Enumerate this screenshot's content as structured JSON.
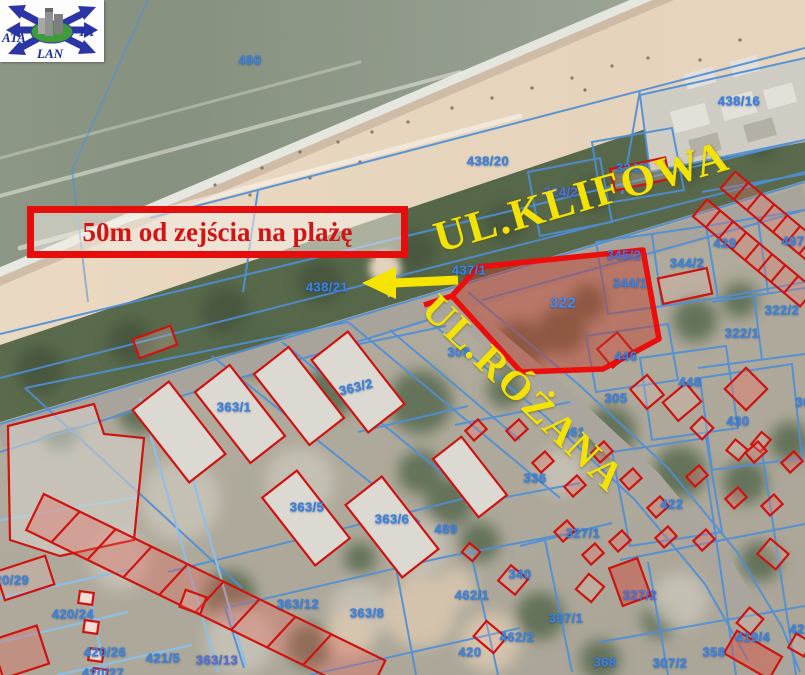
{
  "logo": {
    "left_text": "ATA",
    "right_text": "TA",
    "bottom_text": "LAN"
  },
  "annotation": {
    "text": "50m od zejścia na plażę"
  },
  "streets": {
    "klifowa": "UL.KLIFOWA",
    "rozana": "UL.RÓŻANA"
  },
  "highlighted_parcel": {
    "number": "322"
  },
  "colors": {
    "highlight_red": "#ec0d0d",
    "street_yellow": "#f2e205",
    "parcel_blue": "#3d85dc",
    "annotation_red": "#d41414"
  },
  "parcels": [
    {
      "label": "490",
      "x": 250,
      "y": 60
    },
    {
      "label": "438/16",
      "x": 739,
      "y": 101
    },
    {
      "label": "438/20",
      "x": 488,
      "y": 161
    },
    {
      "label": "324/1",
      "x": 633,
      "y": 168
    },
    {
      "label": "324/2",
      "x": 561,
      "y": 192,
      "cls": "p"
    },
    {
      "label": "344/1",
      "x": 630,
      "y": 283
    },
    {
      "label": "344/2",
      "x": 687,
      "y": 263
    },
    {
      "label": "345/2",
      "x": 624,
      "y": 255,
      "cls": "p"
    },
    {
      "label": "429",
      "x": 725,
      "y": 243
    },
    {
      "label": "497",
      "x": 793,
      "y": 241
    },
    {
      "label": "322/2",
      "x": 782,
      "y": 310
    },
    {
      "label": "322/1",
      "x": 742,
      "y": 333
    },
    {
      "label": "438/21",
      "x": 327,
      "y": 287
    },
    {
      "label": "437/1",
      "x": 469,
      "y": 270
    },
    {
      "label": "308",
      "x": 459,
      "y": 352
    },
    {
      "label": "446",
      "x": 626,
      "y": 356
    },
    {
      "label": "448",
      "x": 690,
      "y": 382
    },
    {
      "label": "430",
      "x": 738,
      "y": 421
    },
    {
      "label": "305",
      "x": 616,
      "y": 398
    },
    {
      "label": "305",
      "x": 807,
      "y": 402
    },
    {
      "label": "361",
      "x": 574,
      "y": 432
    },
    {
      "label": "336",
      "x": 535,
      "y": 478
    },
    {
      "label": "422",
      "x": 672,
      "y": 504
    },
    {
      "label": "327/1",
      "x": 583,
      "y": 533
    },
    {
      "label": "363/1",
      "x": 234,
      "y": 407
    },
    {
      "label": "363/2",
      "x": 356,
      "y": 387,
      "rot": -14
    },
    {
      "label": "363/5",
      "x": 307,
      "y": 507
    },
    {
      "label": "363/6",
      "x": 392,
      "y": 519
    },
    {
      "label": "489",
      "x": 446,
      "y": 529
    },
    {
      "label": "340",
      "x": 520,
      "y": 574
    },
    {
      "label": "462/1",
      "x": 472,
      "y": 595
    },
    {
      "label": "462/2",
      "x": 517,
      "y": 637
    },
    {
      "label": "420",
      "x": 470,
      "y": 652
    },
    {
      "label": "307/1",
      "x": 566,
      "y": 618
    },
    {
      "label": "327/2",
      "x": 640,
      "y": 595,
      "cls": "p"
    },
    {
      "label": "368",
      "x": 605,
      "y": 662
    },
    {
      "label": "307/2",
      "x": 670,
      "y": 663
    },
    {
      "label": "419/4",
      "x": 753,
      "y": 637
    },
    {
      "label": "358",
      "x": 714,
      "y": 652
    },
    {
      "label": "363/12",
      "x": 298,
      "y": 604
    },
    {
      "label": "363/8",
      "x": 367,
      "y": 613
    },
    {
      "label": "363/13",
      "x": 217,
      "y": 660,
      "cls": "p"
    },
    {
      "label": "421/5",
      "x": 163,
      "y": 658
    },
    {
      "label": "420/29",
      "x": 8,
      "y": 580
    },
    {
      "label": "420/24",
      "x": 73,
      "y": 614
    },
    {
      "label": "420/26",
      "x": 105,
      "y": 652
    },
    {
      "label": "420/27",
      "x": 103,
      "y": 673
    },
    {
      "label": "421",
      "x": 801,
      "y": 629
    }
  ]
}
